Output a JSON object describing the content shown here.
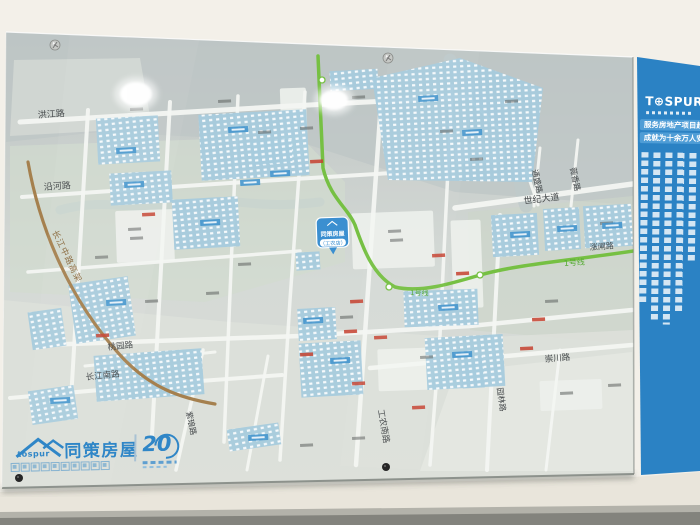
{
  "scene": {
    "description": "photo of wall-mounted glass real-estate district map board",
    "wall_color": "#f3f0e9"
  },
  "banner": {
    "bg": "#2b82c4",
    "bar_color": "#4f9dd6",
    "logo": "T⊕SPUR",
    "logo_reg": "®",
    "line1": "服务房地产项目超",
    "line2": "成就为十余万人安"
  },
  "brand": {
    "en": "tospur",
    "cn": "同策房屋",
    "anniversary": "20"
  },
  "map": {
    "glass": "6,32 633,57 634,474 2,488",
    "banner_poly": "637,57 700,66 700,471 641,475",
    "block_fill": "#a6cbdd",
    "zones": [
      {
        "p": "6,32 633,57 633,205 455,192 300,142 100,132 6,142",
        "f": "#bec6c5",
        "o": 0.75
      },
      {
        "p": "10,146 300,136 345,182 345,262 205,302 10,292",
        "f": "#d2dbce",
        "o": 0.7
      },
      {
        "p": "468,212 633,196 633,345 470,330",
        "f": "#ccd5ca",
        "o": 0.65
      },
      {
        "p": "3,300 230,322 470,338 633,330 633,473 3,487",
        "f": "#dde0da",
        "o": 0.9
      },
      {
        "p": "455,372 632,352 633,471 420,471",
        "f": "#e4e7e1",
        "o": 1
      },
      {
        "p": "14,60 140,58 152,128 10,136",
        "f": "#d4d9d5",
        "o": 0.8
      }
    ],
    "rivers": [
      {
        "d": "M450,60 C470,95 505,115 515,150 C522,172 518,185 526,206",
        "w": 13,
        "c": "#bdc9cb",
        "o": 0.75
      },
      {
        "d": "M60,210 C110,196 140,214 195,204 C235,196 255,210 320,202",
        "w": 9,
        "c": "#c6d2cf",
        "o": 0.65
      }
    ],
    "white_blocks": [
      [
        116,
        210,
        58,
        52
      ],
      [
        281,
        88,
        26,
        70
      ],
      [
        352,
        212,
        82,
        56
      ],
      [
        452,
        220,
        30,
        88
      ],
      [
        378,
        348,
        78,
        42
      ],
      [
        540,
        380,
        62,
        30
      ],
      [
        455,
        143,
        50,
        20
      ]
    ],
    "roads": [
      {
        "d": "M20,122 L290,106 L465,97",
        "w": 5
      },
      {
        "d": "M22,197 L230,183 L392,173",
        "w": 4
      },
      {
        "d": "M28,272 L300,251",
        "w": 3.5
      },
      {
        "d": "M40,345 L300,336 L470,326 L632,310",
        "w": 4.5
      },
      {
        "d": "M10,398 L200,381 L282,375",
        "w": 4
      },
      {
        "d": "M370,368 L632,345",
        "w": 4.5
      },
      {
        "d": "M455,208 L640,183",
        "w": 5.5
      },
      {
        "d": "M85,366 L215,352",
        "w": 3
      },
      {
        "d": "M88,110 L71,400",
        "w": 4
      },
      {
        "d": "M170,102 L152,435",
        "w": 4
      },
      {
        "d": "M238,96 L224,442",
        "w": 3.5
      },
      {
        "d": "M305,92 L290,300 L280,460",
        "w": 3.5
      },
      {
        "d": "M382,88 L368,290 L356,465",
        "w": 4.5
      },
      {
        "d": "M452,86 L440,335 L430,465",
        "w": 3.5
      },
      {
        "d": "M500,215 L487,470",
        "w": 4
      },
      {
        "d": "M203,350 L176,470",
        "w": 3.5
      },
      {
        "d": "M268,356 L247,470",
        "w": 3
      },
      {
        "d": "M560,350 L546,470",
        "w": 3
      },
      {
        "d": "M540,148 L534,206",
        "w": 3
      },
      {
        "d": "M578,140 L571,206",
        "w": 3
      },
      {
        "d": "M468,97 L520,152 L538,205",
        "w": 3
      }
    ],
    "blocks": [
      [
        97,
        117,
        62,
        46,
        -3
      ],
      [
        200,
        112,
        108,
        66,
        -3
      ],
      [
        330,
        70,
        48,
        20,
        -3
      ],
      [
        110,
        172,
        62,
        32,
        -3
      ],
      [
        173,
        198,
        66,
        50,
        -3
      ],
      [
        252,
        140,
        40,
        24,
        -3
      ],
      [
        72,
        280,
        60,
        60,
        -8
      ],
      [
        30,
        310,
        34,
        38,
        -8
      ],
      [
        95,
        352,
        108,
        46,
        -4
      ],
      [
        300,
        342,
        62,
        54,
        -3
      ],
      [
        426,
        336,
        78,
        52,
        -3
      ],
      [
        492,
        214,
        46,
        42,
        -3
      ],
      [
        544,
        208,
        36,
        42,
        -3
      ],
      [
        584,
        205,
        48,
        42,
        -3
      ],
      [
        404,
        290,
        74,
        36,
        -2
      ],
      [
        462,
        356,
        22,
        32,
        -3
      ],
      [
        228,
        426,
        52,
        22,
        -8
      ],
      [
        30,
        388,
        46,
        34,
        -8
      ],
      [
        298,
        308,
        38,
        32,
        -3
      ],
      [
        296,
        252,
        24,
        18,
        -3
      ]
    ],
    "blocks_poly": [
      "372,78 460,58 543,88 532,182 388,180"
    ],
    "elevated": {
      "d": "M28,162 C40,230 70,300 120,355 C150,388 180,398 215,404",
      "color": "#a5804e",
      "w": 3.2
    },
    "metro": {
      "d": "M318,56 L323,168 C330,198 348,208 355,225 C362,245 372,275 395,287 C420,293 450,284 480,275 C520,264 560,262 640,250",
      "color": "#76c043",
      "w": 3.5,
      "stations": [
        [
          322,
          80
        ],
        [
          389,
          287
        ],
        [
          480,
          275
        ]
      ]
    },
    "labels": [
      {
        "t": "洪江路",
        "x": 38,
        "y": 118,
        "r": -4,
        "s": 9
      },
      {
        "t": "沿河路",
        "x": 44,
        "y": 190,
        "r": -4,
        "s": 9
      },
      {
        "t": "长江中路高架",
        "x": 52,
        "y": 232,
        "r": 64,
        "s": 8.5,
        "c": "#8a6a3f",
        "ls": 1
      },
      {
        "t": "桃园路",
        "x": 108,
        "y": 350,
        "r": -6,
        "s": 8.5
      },
      {
        "t": "长江南路",
        "x": 86,
        "y": 380,
        "r": -6,
        "s": 8.5
      },
      {
        "t": "紫琅路",
        "x": 186,
        "y": 412,
        "r": 78,
        "s": 8
      },
      {
        "t": "工农南路",
        "x": 378,
        "y": 410,
        "r": 80,
        "s": 8.5
      },
      {
        "t": "园林路",
        "x": 497,
        "y": 388,
        "r": 82,
        "s": 8
      },
      {
        "t": "崇川路",
        "x": 545,
        "y": 362,
        "r": -5,
        "s": 8.5
      },
      {
        "t": "世纪大道",
        "x": 524,
        "y": 204,
        "r": -7,
        "s": 9
      },
      {
        "t": "薇香路",
        "x": 570,
        "y": 168,
        "r": 78,
        "s": 8
      },
      {
        "t": "通盛路",
        "x": 532,
        "y": 170,
        "r": 78,
        "s": 8
      },
      {
        "t": "涨闸路",
        "x": 590,
        "y": 250,
        "r": -4,
        "s": 8
      },
      {
        "t": "1号线",
        "x": 564,
        "y": 266,
        "r": -4,
        "s": 8,
        "c": "#57ab35"
      },
      {
        "t": "1号线",
        "x": 410,
        "y": 295,
        "r": 2,
        "s": 7,
        "c": "#57ab35"
      }
    ],
    "bubble": {
      "x": 316,
      "y": 218,
      "w": 32,
      "h": 30,
      "color": "#3b8fd0",
      "title": "同策房屋",
      "sub": "（工农店）"
    },
    "tags": {
      "gray": [
        [
          130,
          108
        ],
        [
          218,
          100
        ],
        [
          258,
          131
        ],
        [
          352,
          96
        ],
        [
          300,
          127
        ],
        [
          470,
          158
        ],
        [
          128,
          228
        ],
        [
          130,
          237
        ],
        [
          388,
          230
        ],
        [
          390,
          239
        ],
        [
          238,
          263
        ],
        [
          206,
          292
        ],
        [
          145,
          300
        ],
        [
          340,
          316
        ],
        [
          420,
          356
        ],
        [
          545,
          300
        ],
        [
          600,
          222
        ],
        [
          300,
          444
        ],
        [
          352,
          437
        ],
        [
          560,
          392
        ],
        [
          608,
          384
        ],
        [
          95,
          256
        ],
        [
          440,
          130
        ],
        [
          505,
          100
        ]
      ],
      "red": [
        [
          142,
          213
        ],
        [
          310,
          160
        ],
        [
          344,
          330
        ],
        [
          374,
          336
        ],
        [
          300,
          353
        ],
        [
          412,
          406
        ],
        [
          456,
          272
        ],
        [
          520,
          347
        ],
        [
          350,
          300
        ],
        [
          96,
          334
        ],
        [
          532,
          318
        ],
        [
          352,
          382
        ],
        [
          432,
          254
        ]
      ],
      "blue": [
        [
          116,
          148
        ],
        [
          228,
          127
        ],
        [
          270,
          171
        ],
        [
          200,
          220
        ],
        [
          124,
          182
        ],
        [
          418,
          96
        ],
        [
          462,
          130
        ],
        [
          303,
          318
        ],
        [
          330,
          358
        ],
        [
          452,
          352
        ],
        [
          510,
          232
        ],
        [
          557,
          226
        ],
        [
          602,
          223
        ],
        [
          438,
          305
        ],
        [
          248,
          435
        ],
        [
          106,
          300
        ],
        [
          50,
          398
        ],
        [
          240,
          180
        ]
      ]
    },
    "glares": [
      [
        136,
        94,
        16,
        12
      ],
      [
        334,
        100,
        14,
        10
      ]
    ],
    "screws": [
      [
        55,
        45
      ],
      [
        388,
        58
      ]
    ],
    "dots": [
      [
        19,
        478
      ],
      [
        386,
        467
      ]
    ]
  }
}
